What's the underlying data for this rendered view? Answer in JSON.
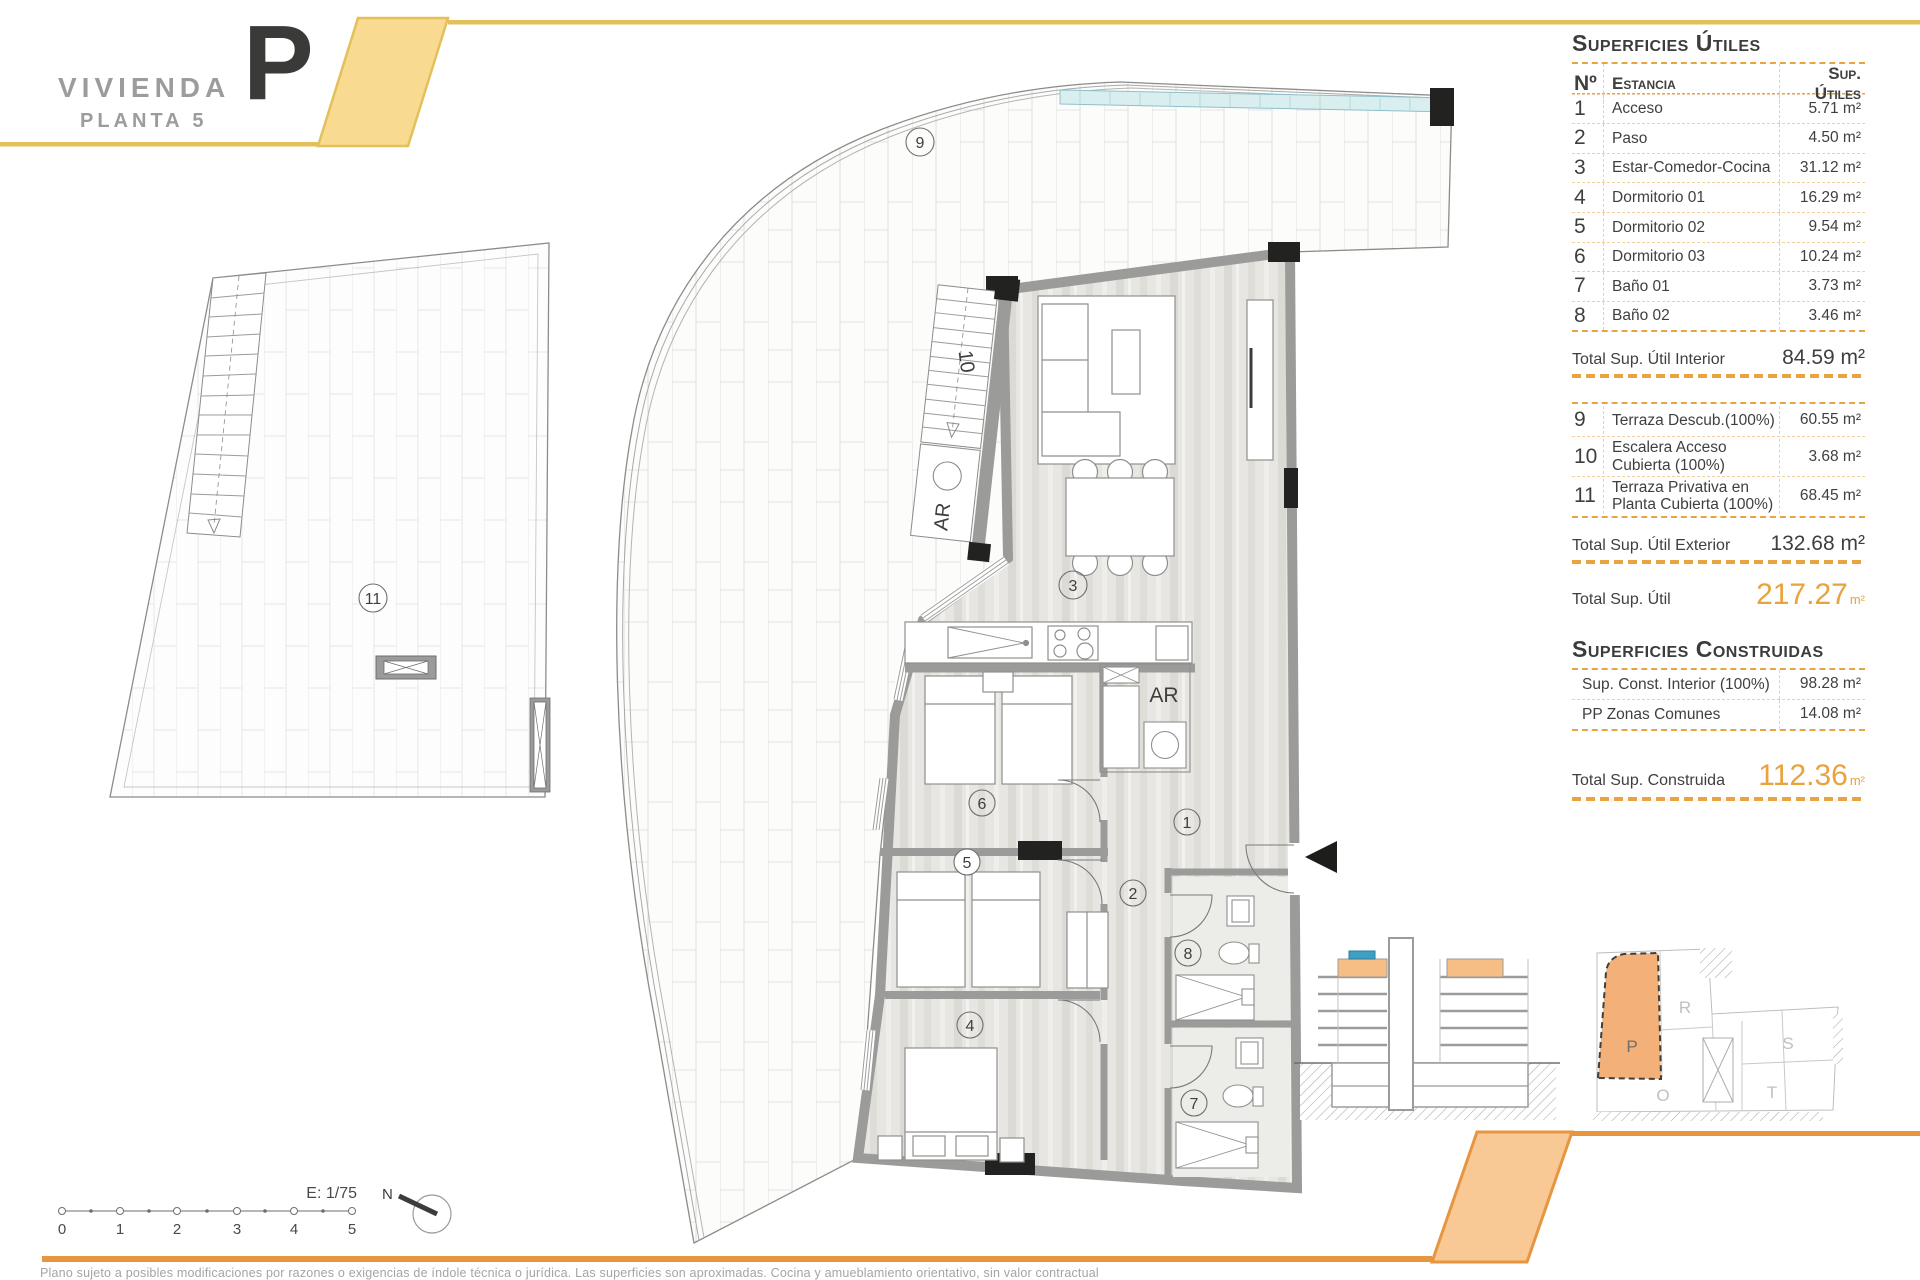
{
  "header": {
    "title": "VIVIENDA",
    "subtitle": "PLANTA 5",
    "unit_letter": "P"
  },
  "panel": {
    "utiles": {
      "title": "Superficies Útiles",
      "col_num": "Nº",
      "col_room": "Estancia",
      "col_area": "Sup. Útiles",
      "rows": [
        {
          "num": "1",
          "room": "Acceso",
          "area": "5.71 m²"
        },
        {
          "num": "2",
          "room": "Paso",
          "area": "4.50 m²"
        },
        {
          "num": "3",
          "room": "Estar-Comedor-Cocina",
          "area": "31.12 m²"
        },
        {
          "num": "4",
          "room": "Dormitorio 01",
          "area": "16.29 m²"
        },
        {
          "num": "5",
          "room": "Dormitorio 02",
          "area": "9.54 m²"
        },
        {
          "num": "6",
          "room": "Dormitorio 03",
          "area": "10.24 m²"
        },
        {
          "num": "7",
          "room": "Baño 01",
          "area": "3.73 m²"
        },
        {
          "num": "8",
          "room": "Baño 02",
          "area": "3.46 m²"
        }
      ],
      "total_interior_label": "Total Sup. Útil Interior",
      "total_interior_value": "84.59 m²",
      "ext_rows": [
        {
          "num": "9",
          "line1": "Terraza Descub.(100%)",
          "line2": "",
          "area": "60.55 m²"
        },
        {
          "num": "10",
          "line1": "Escalera Acceso",
          "line2": "Cubierta (100%)",
          "area": "3.68 m²"
        },
        {
          "num": "11",
          "line1": "Terraza Privativa en",
          "line2": "Planta Cubierta (100%)",
          "area": "68.45 m²"
        }
      ],
      "total_exterior_label": "Total Sup. Útil Exterior",
      "total_exterior_value": "132.68 m²",
      "total_label": "Total Sup. Útil",
      "total_value": "217.27",
      "total_unit": "m²"
    },
    "construidas": {
      "title": "Superficies Construidas",
      "rows": [
        {
          "room": "Sup. Const. Interior (100%)",
          "area": "98.28 m²"
        },
        {
          "room": "PP Zonas Comunes",
          "area": "14.08 m²"
        }
      ],
      "total_label": "Total Sup. Construida",
      "total_value": "112.36",
      "total_unit": "m²"
    }
  },
  "plan": {
    "labels": {
      "n1": "1",
      "n2": "2",
      "n3": "3",
      "n4": "4",
      "n5": "5",
      "n6": "6",
      "n7": "7",
      "n8": "8",
      "n9": "9",
      "n10": "10",
      "n11": "11"
    },
    "ar_label": "AR",
    "scale_label": "E: 1/75",
    "north_label": "N",
    "ticks": [
      "0",
      "1",
      "2",
      "3",
      "4",
      "5"
    ]
  },
  "site": {
    "labels": {
      "p": "P",
      "r": "R",
      "s": "S",
      "t": "T",
      "o": "O"
    }
  },
  "footer": {
    "disclaimer": "Plano sujeto a posibles modificaciones por razones o exigencias de índole técnica o jurídica. Las superficies son aproximadas. Cocina y amueblamiento orientativo, sin valor contractual"
  },
  "colors": {
    "accent_orange": "#E8953F",
    "accent_yellow": "#E4C05A",
    "band_yellow_fill": "#F8DA90",
    "band_orange_fill": "#F9C995",
    "table_dash": "#E9A33F",
    "total_orange": "#E9A23C",
    "text_dark": "#3C3C3B",
    "text_gray": "#9C9C9B",
    "wall_gray": "#9B9B9A",
    "highlight_unit": "#F3B078"
  }
}
